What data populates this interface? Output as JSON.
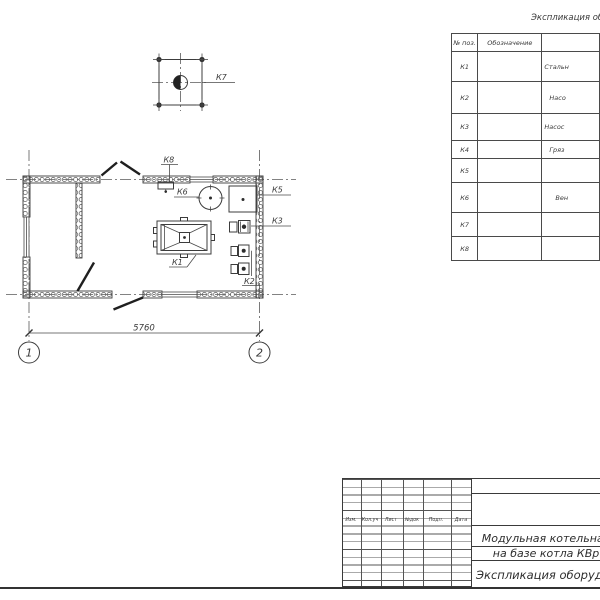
{
  "plan": {
    "labels": {
      "k1": "К1",
      "k2": "К2",
      "k3": "К3",
      "k5": "К5",
      "k6": "К6",
      "k7": "К7",
      "k8": "К8"
    },
    "dimension_width": "5760",
    "axis_left": "1",
    "axis_right": "2"
  },
  "spec_table": {
    "title": "Экспликация оборудования",
    "col_pos": "№ поз.",
    "col_designation": "Обозначение",
    "rows": [
      {
        "pos": "К1",
        "name": "Стальн"
      },
      {
        "pos": "К2",
        "name": "Насо"
      },
      {
        "pos": "К3",
        "name": "Насос"
      },
      {
        "pos": "К4",
        "name": "Гряз"
      },
      {
        "pos": "К5",
        "name": ""
      },
      {
        "pos": "К6",
        "name": "Вен"
      },
      {
        "pos": "К7",
        "name": ""
      },
      {
        "pos": "К8",
        "name": ""
      }
    ]
  },
  "title_block": {
    "revision_headers": [
      "Изм.",
      "Кол.уч",
      "Лист",
      "№док",
      "Подп.",
      "Дата"
    ],
    "project_line1": "Модульная котельная",
    "project_line2": "на базе котла КВр",
    "document_name": "Экспликация оборудования"
  }
}
